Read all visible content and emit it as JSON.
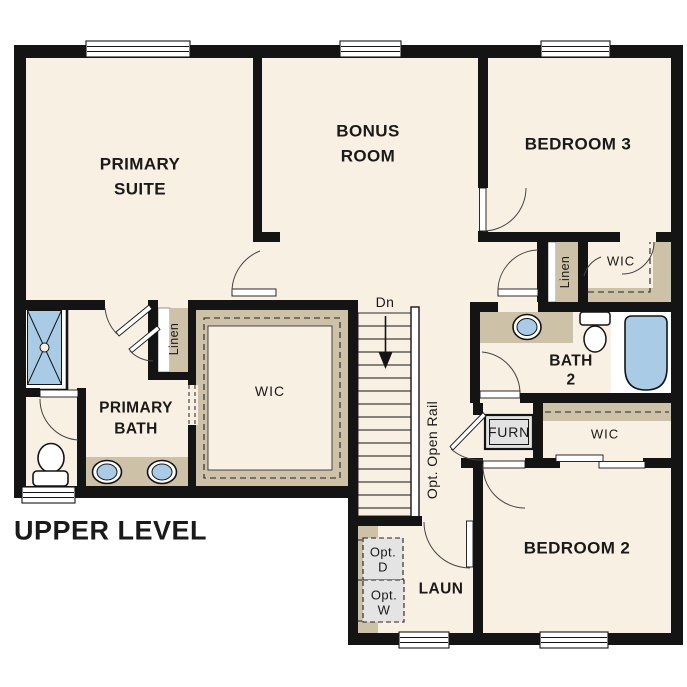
{
  "title": {
    "text": "UPPER LEVEL"
  },
  "colors": {
    "floor": "#f8f0e2",
    "wall": "#141414",
    "shelf_tan": "#cdc1a8",
    "fixture_blue": "#a9cbe5",
    "appliance_gray": "#e4e4e4",
    "line": "#333333"
  },
  "rooms": {
    "primary_suite": {
      "line1": "PRIMARY",
      "line2": "SUITE"
    },
    "bonus_room": {
      "line1": "BONUS",
      "line2": "ROOM"
    },
    "bedroom3": {
      "label": "BEDROOM 3"
    },
    "bedroom2": {
      "label": "BEDROOM 2"
    },
    "primary_bath": {
      "line1": "PRIMARY",
      "line2": "BATH"
    },
    "bath2": {
      "line1": "BATH",
      "line2": "2"
    },
    "laundry": {
      "label": "LAUN"
    }
  },
  "closets": {
    "wic_primary": "WIC",
    "wic_bedroom3": "WIC",
    "wic_bedroom2": "WIC",
    "linen_primary": "Linen",
    "linen_bedroom3": "Linen"
  },
  "stairs": {
    "down_label": "Dn",
    "rail_label": "Opt. Open Rail"
  },
  "equipment": {
    "furnace": "FURN",
    "opt_dryer_line1": "Opt.",
    "opt_dryer_line2": "D",
    "opt_washer_line1": "Opt.",
    "opt_washer_line2": "W"
  }
}
